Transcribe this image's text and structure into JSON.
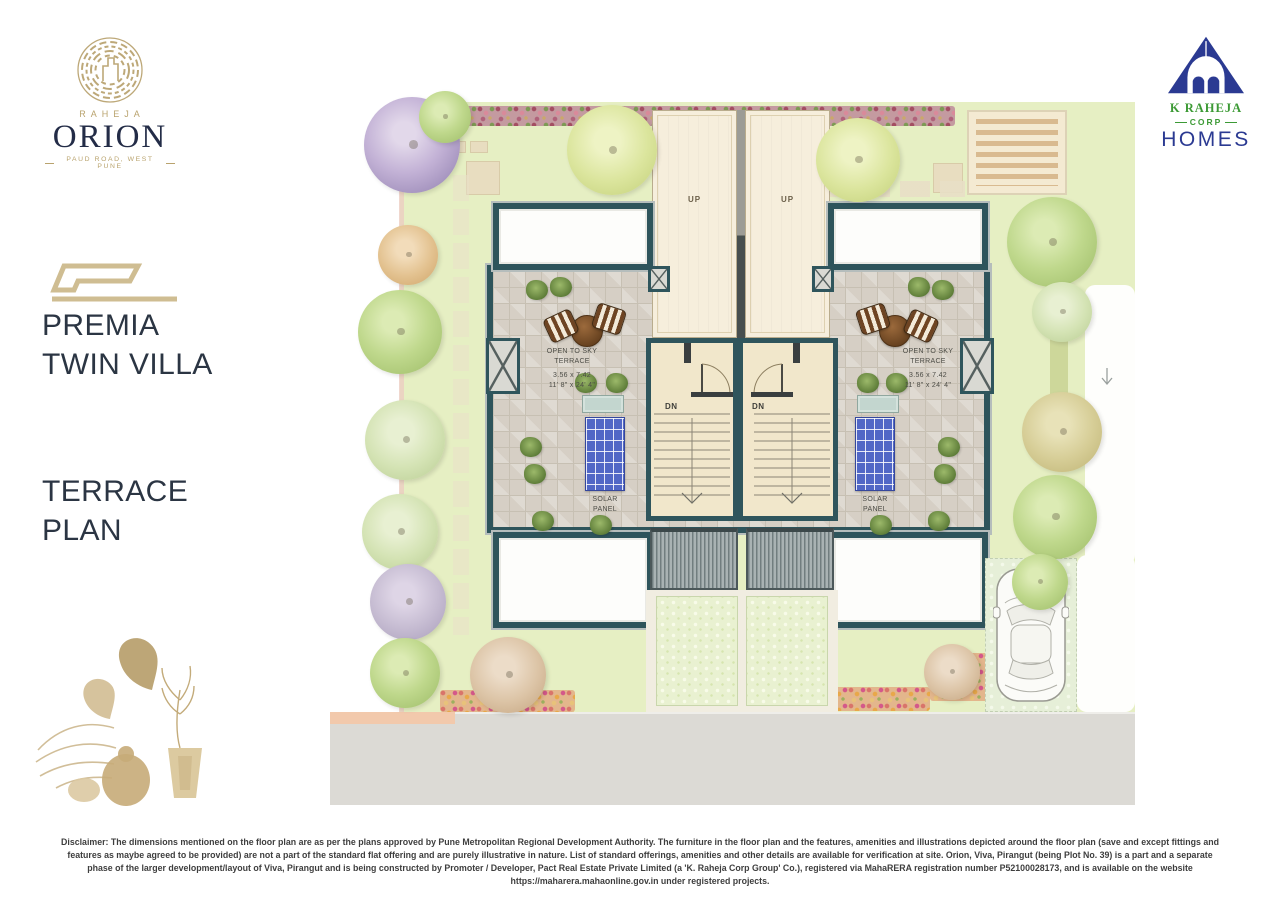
{
  "orion_logo": {
    "brand": "RAHEJA",
    "name": "ORION",
    "tagline": "PAUD ROAD, WEST PUNE"
  },
  "corp_logo": {
    "company": "K RAHEJA",
    "corp": "CORP",
    "division": "HOMES"
  },
  "sidebar": {
    "project_name_line1": "PREMIA",
    "project_name_line2": "TWIN VILLA",
    "plan_title_line1": "TERRACE",
    "plan_title_line2": "PLAN"
  },
  "plan": {
    "up_label": "UP",
    "dn_label": "DN",
    "terrace_label_line1": "OPEN TO SKY",
    "terrace_label_line2": "TERRACE",
    "terrace_dim_metric": "3.56 x 7.42",
    "terrace_dim_imperial": "11' 8\" x 24' 4\"",
    "solar_label_line1": "SOLAR",
    "solar_label_line2": "PANEL"
  },
  "disclaimer": "Disclaimer: The dimensions mentioned on the floor plan are as per the plans approved by Pune Metropolitan Regional Development Authority. The furniture in the floor plan and the features, amenities and illustrations depicted around the floor plan (save and except fittings and features as maybe agreed to be provided) are not a part of the standard flat offering and are purely illustrative in nature. List of standard offerings, amenities and other details are available for verification at site. Orion, Viva, Pirangut (being Plot No. 39) is a part and a separate phase of the larger development/layout of Viva, Pirangut and is being constructed by Promoter / Developer, Pact Real Estate Private Limited (a 'K. Raheja Corp Group' Co.), registered via MahaRERA registration number P52100028173, and is available on the website https://maharera.mahaonline.gov.in under registered projects.",
  "colors": {
    "accent_gold": "#b9a36e",
    "brand_navy": "#232c47",
    "corp_blue": "#2b3a92",
    "corp_green": "#3c9a35",
    "wall_teal": "#2e545b",
    "lawn_green": "#e6efc3",
    "solar_blue": "#5167c6"
  }
}
